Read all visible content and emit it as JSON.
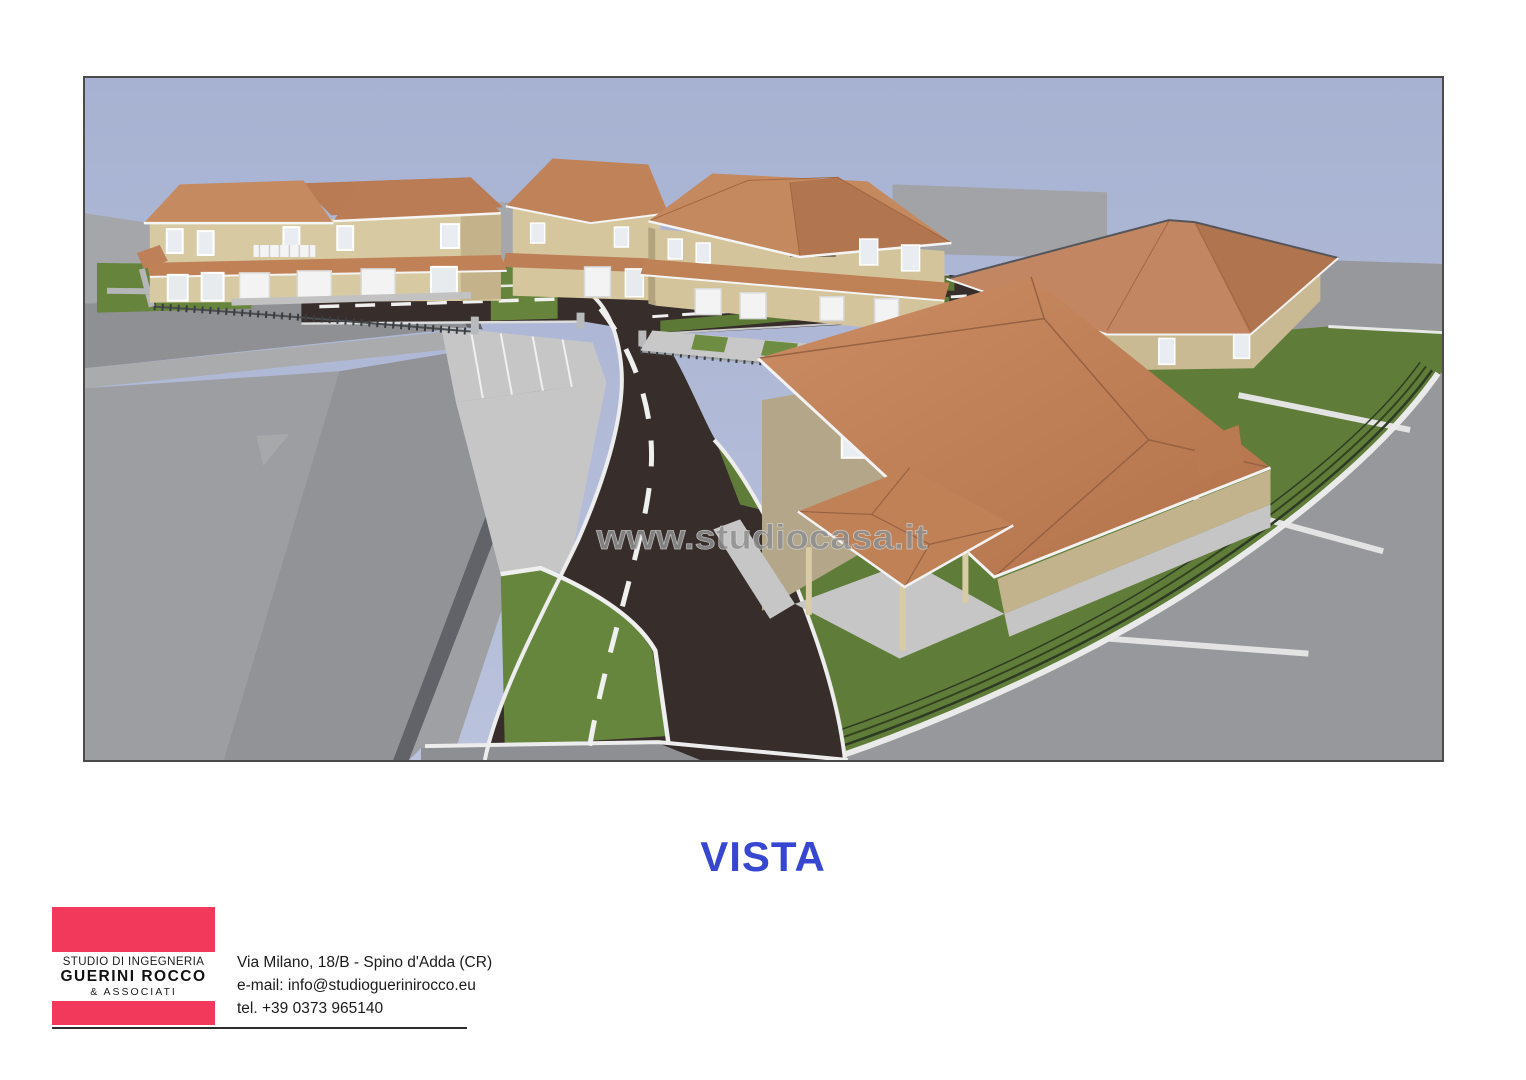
{
  "render": {
    "watermark": "www.studiocasa.it",
    "colors": {
      "sky": "#aab5d4",
      "roof_terracotta": "#c2855c",
      "wall_tan": "#d6c79f",
      "road_asphalt": "#372d2a",
      "grass": "#5f7d38",
      "existing_gray": "#97989b",
      "pavement": "#c6c6c7",
      "curb_white": "#eeeeee",
      "frame_border": "#4b4b4b"
    }
  },
  "caption": {
    "text": "VISTA",
    "color": "#3847d2"
  },
  "title_block": {
    "firm": {
      "line1": "STUDIO DI INGEGNERIA",
      "name": "GUERINI ROCCO",
      "line3": "& ASSOCIATI",
      "brand_color": "#f2395c"
    },
    "contact": {
      "address": "Via Milano, 18/B - Spino d'Adda (CR)",
      "email": "e-mail: info@studioguerinirocco.eu",
      "phone": "tel. +39 0373 965140"
    }
  }
}
